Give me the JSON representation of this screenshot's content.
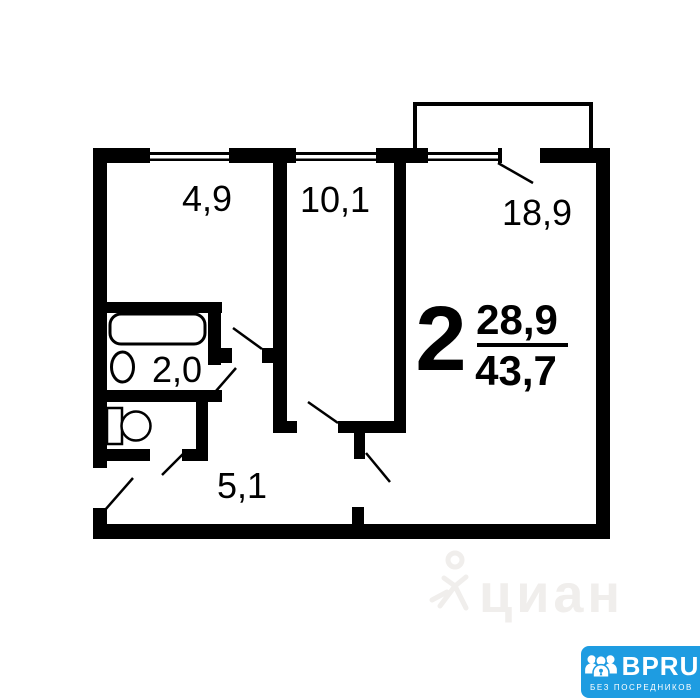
{
  "plan": {
    "flat_type_label": "2",
    "living_area": "28,9",
    "total_area": "43,7",
    "rooms": [
      {
        "id": "kitchen",
        "area": "4,9"
      },
      {
        "id": "room-small",
        "area": "10,1"
      },
      {
        "id": "room-large",
        "area": "18,9"
      },
      {
        "id": "bathroom",
        "area": "2,0"
      },
      {
        "id": "hallway",
        "area": "5,1"
      }
    ]
  },
  "watermark": {
    "text": "циан"
  },
  "logo": {
    "title": "BPRU",
    "subtitle": "БЕЗ ПОСРЕДНИКОВ"
  },
  "colors": {
    "wall": "#000000",
    "background": "#ffffff",
    "watermark": "#f0eeec",
    "logo_blue": "#1e9ce1",
    "logo_text": "#ffffff"
  }
}
